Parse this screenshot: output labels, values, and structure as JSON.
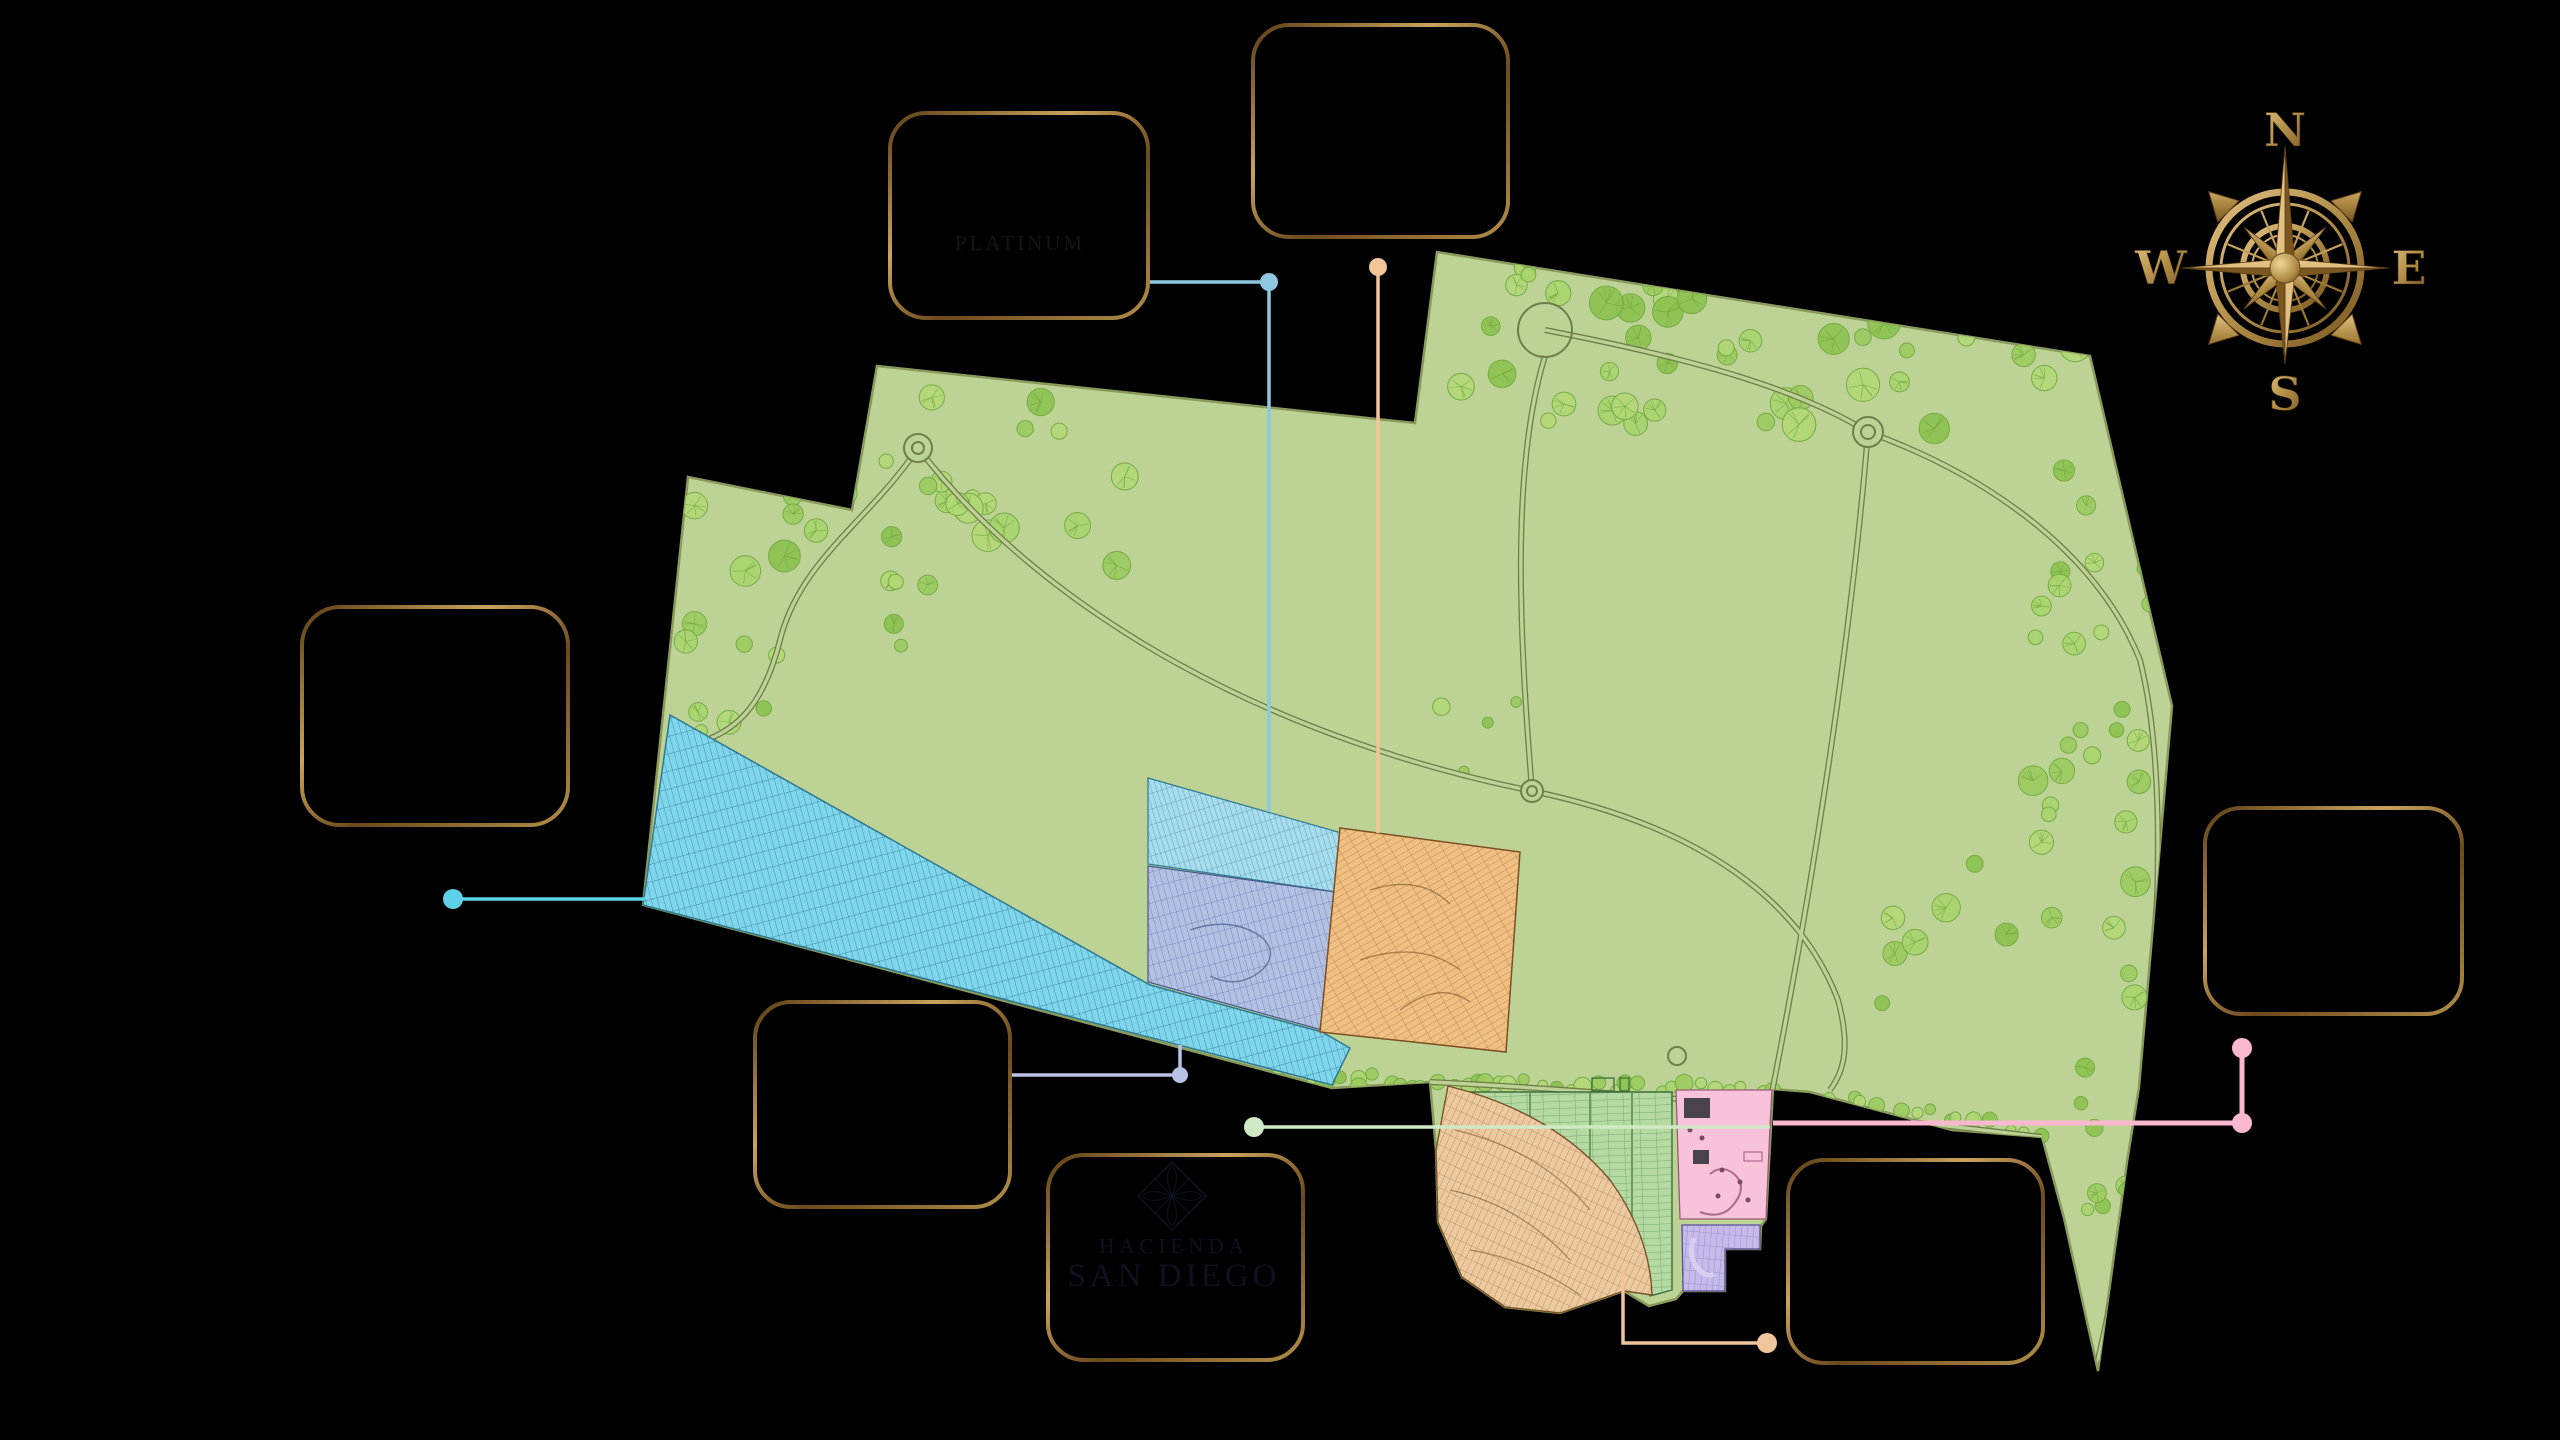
{
  "page": {
    "background": "#000000"
  },
  "brand": {
    "gold": "#b08d47",
    "gold_dark": "#5d3f16",
    "gold_light": "#d8b36b"
  },
  "compass": {
    "north": "N",
    "east": "E",
    "south": "S",
    "west": "W",
    "icon": "compass-rose-icon"
  },
  "callouts": {
    "platinum": {
      "label": "PLATINUM",
      "text_color": "#151515"
    }
  },
  "logo": {
    "line1": "HACIENDA",
    "line2": "SAN DIEGO",
    "color": "#0e1220",
    "icon": "diamond-flower-icon"
  },
  "map": {
    "park_color": "#bdd295",
    "park_stroke": "#8a9a5d",
    "tree_color": "#9ccb5f",
    "road_color": "#6f7f4b",
    "zones": {
      "cyan_wedge": {
        "color": "#7fd6ec"
      },
      "sky_rows": {
        "color": "#a6dcec"
      },
      "periwinkle": {
        "color": "#b2c0e2"
      },
      "orange": {
        "color": "#f1bf82"
      },
      "green_lots": {
        "color": "#b4d9a2"
      },
      "pink_amenity": {
        "color": "#f8c3da"
      },
      "purple": {
        "color": "#c5bae9"
      },
      "tan_fan": {
        "color": "#edc9a0"
      }
    }
  },
  "leaders": {
    "cyan": "#5ed0ea",
    "steel_blue": "#8ec7e2",
    "peach": "#f2c498",
    "pale_green": "#cfe9c4",
    "pink": "#f9b8cf",
    "lavender": "#b9c2e4"
  }
}
